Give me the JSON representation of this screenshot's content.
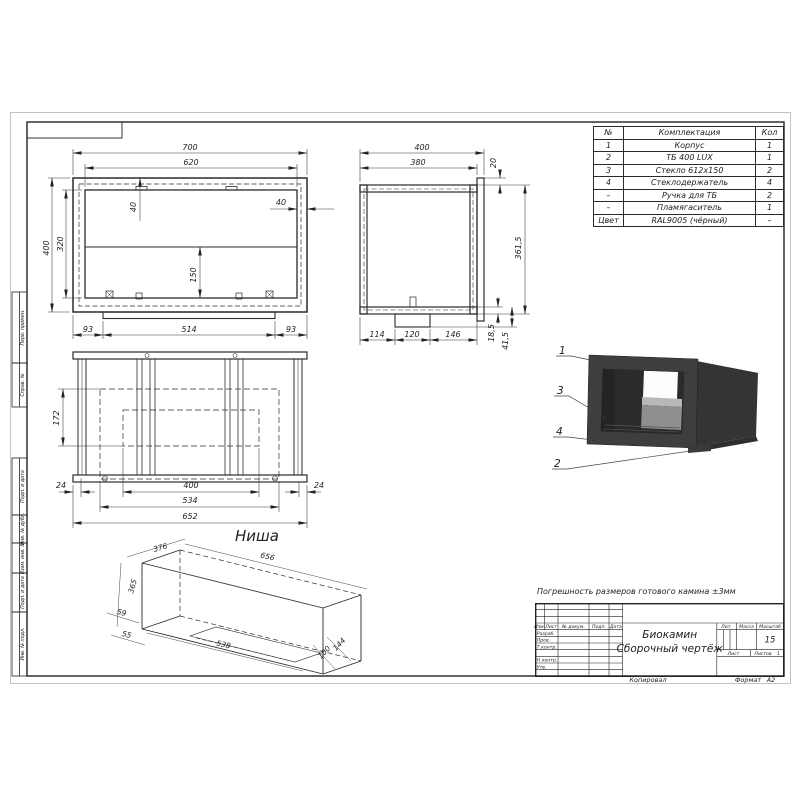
{
  "sheet": {
    "tolerance_note": "Погрешность размеров готового камина ±3мм",
    "copied_label": "Копировал",
    "format_label": "Формат",
    "format_value": "А2"
  },
  "frame_stamps": [
    "Перв. примен.",
    "Справ. №",
    "Подп. и дата",
    "Инв. № дубл.",
    "Взам. инв. №",
    "Подп. и дата",
    "Инв. № подл."
  ],
  "parts_table": {
    "headers": [
      "№",
      "Комплектация",
      "Кол"
    ],
    "rows": [
      [
        "1",
        "Корпус",
        "1"
      ],
      [
        "2",
        "ТБ 400 LUX",
        "1"
      ],
      [
        "3",
        "Стекло 612х150",
        "2"
      ],
      [
        "4",
        "Стеклодержатель",
        "4"
      ],
      [
        "–",
        "Ручка для ТБ",
        "2"
      ],
      [
        "–",
        "Пламягаситель",
        "1"
      ],
      [
        "Цвет",
        "RAL9005 (чёрный)",
        "–"
      ]
    ]
  },
  "front_view": {
    "w_outer": "700",
    "w_inner": "620",
    "h_outer": "400",
    "h_inner": "320",
    "inset_top": "40",
    "inset_side": "40",
    "glass_h": "150",
    "b_left": "93",
    "b_mid": "514",
    "b_right": "93"
  },
  "side_view": {
    "w_outer": "400",
    "w_inner": "380",
    "flange": "20",
    "body_h": "361,5",
    "plate_h": "18,5",
    "base_h": "41,5",
    "b1": "114",
    "b2": "120",
    "b3": "146"
  },
  "top_view": {
    "depth": "172",
    "e_left": "24",
    "opening": "400",
    "inner_w": "534",
    "outer_w": "652",
    "e_right": "24",
    "caption": "Ниша"
  },
  "niche_view": {
    "depth": "376",
    "length": "656",
    "height": "365",
    "dim59": "59",
    "dim55": "55",
    "dim538": "538",
    "dim100": "100",
    "dim144": "144"
  },
  "callouts": {
    "one": "1",
    "two": "2",
    "three": "3",
    "four": "4"
  },
  "title_block": {
    "product": "Биокамин",
    "doc_type": "Сборочный чертёж",
    "col_izm": "Изм.",
    "col_list": "Лист",
    "col_doc": "№ докум.",
    "col_sign": "Подп.",
    "col_date": "Дата",
    "row_razrab": "Разраб.",
    "row_prov": "Пров.",
    "row_tkontr": "Т.контр.",
    "row_nkontr": "Н.контр.",
    "row_utv": "Утв.",
    "lit_label": "Лит.",
    "mass_label": "Масса",
    "scale_label": "Масштаб",
    "scale_value": "15",
    "sheet_label": "Лист",
    "sheets_label": "Листов",
    "sheets_value": "1"
  }
}
